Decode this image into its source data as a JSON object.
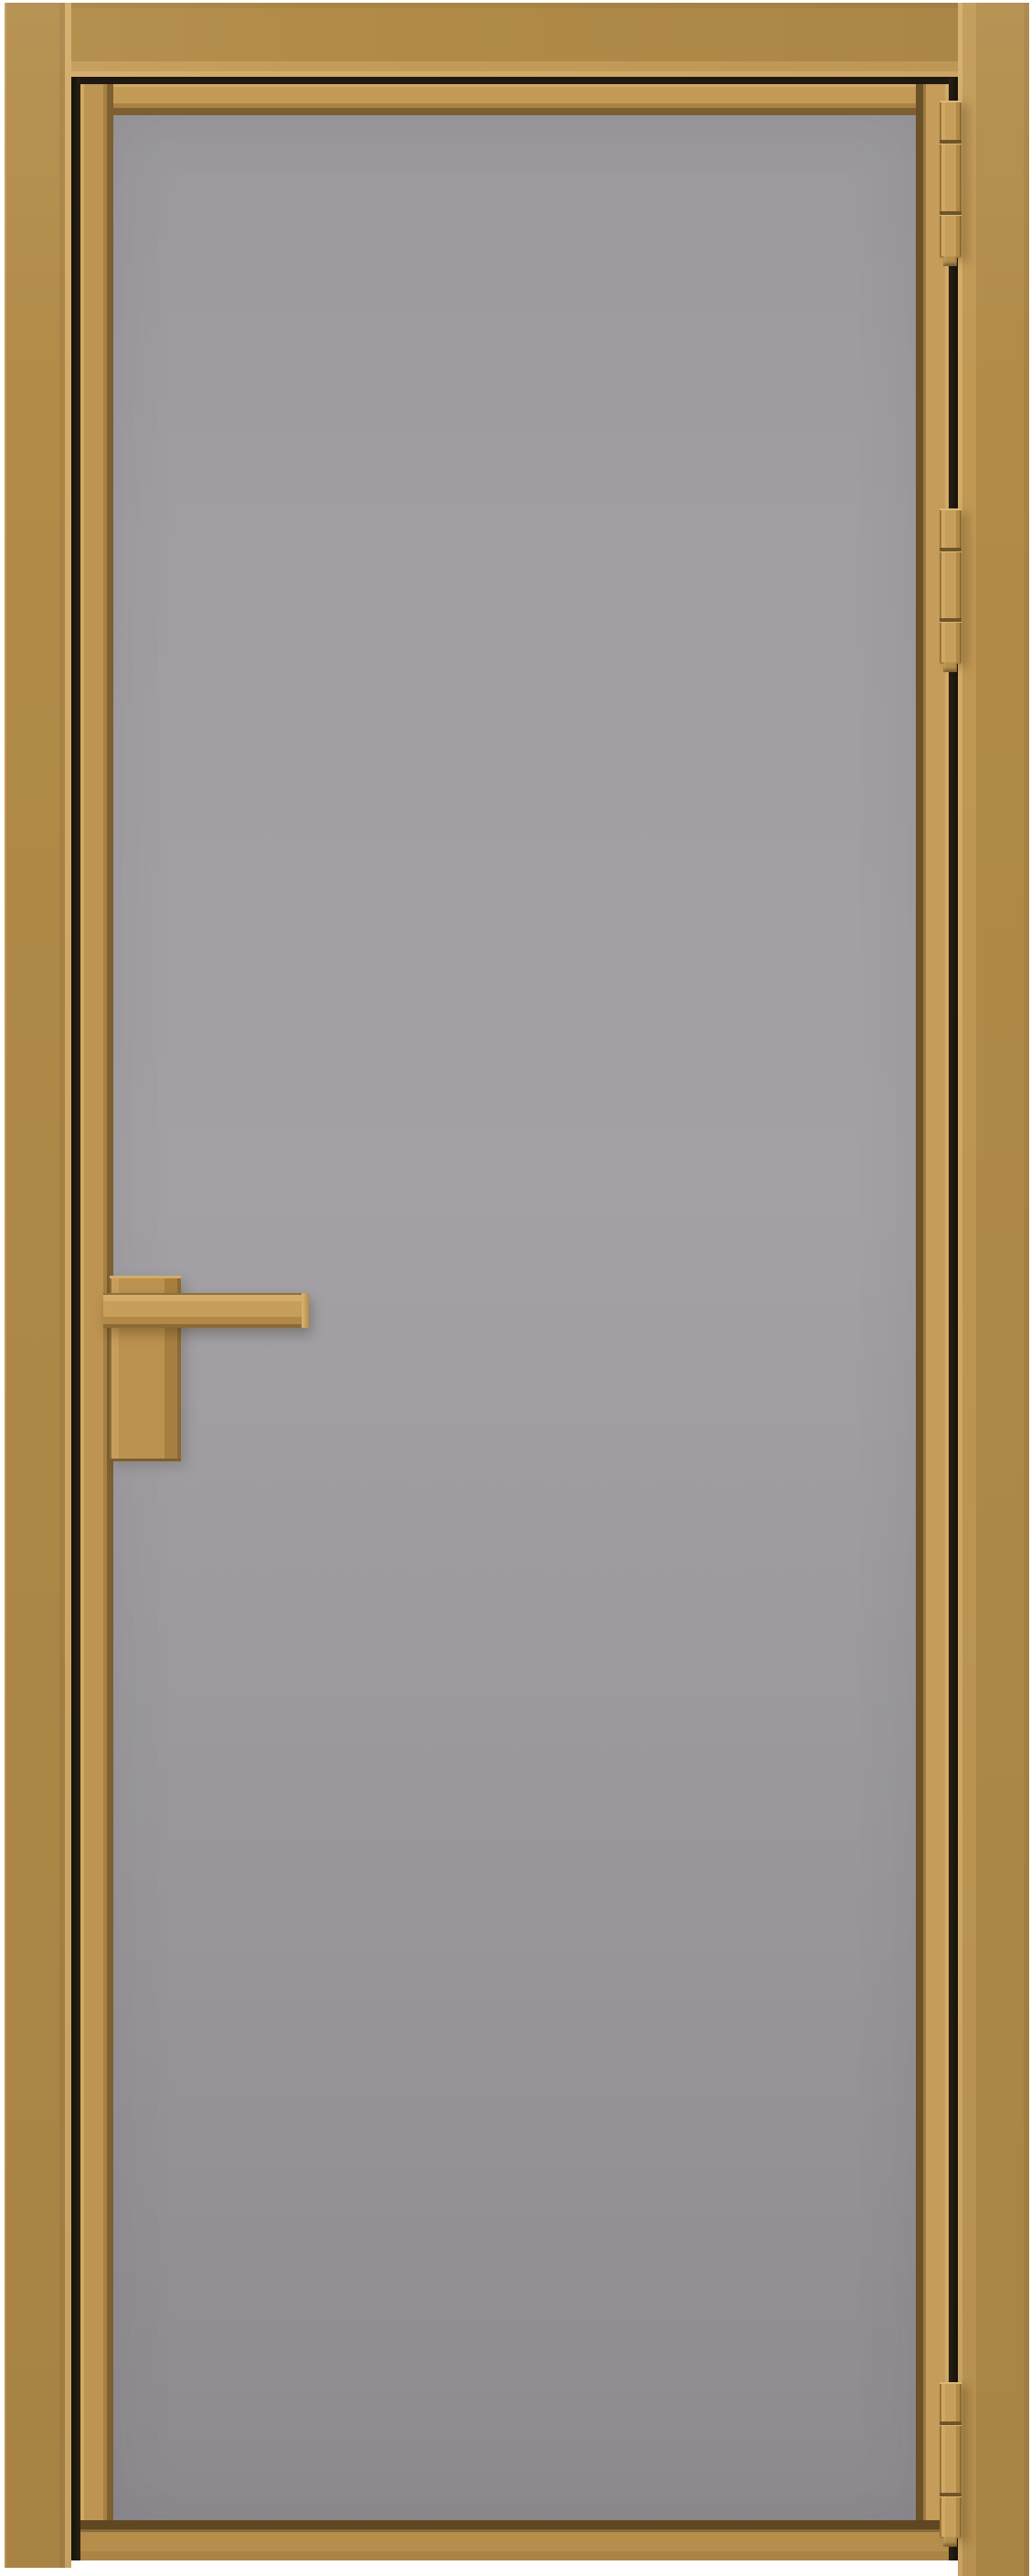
{
  "meta": {
    "type": "product-photo",
    "subject": "Interior single-leaf matte glass door in a gold aluminium frame",
    "view": "front",
    "text_content": "none"
  },
  "door": {
    "frame": {
      "material": "aluminium",
      "finish": "gold",
      "color": "#b28b48"
    },
    "leaf": {
      "frame_color": "#bd9451",
      "edge_highlight": "#d2ab68",
      "bevel_shadow": "#7d5f30"
    },
    "glass": {
      "finish": "matte",
      "color_top": "#9b999d",
      "color_mid": "#a3a1a5",
      "color_bottom": "#8d8b8f"
    },
    "gap_color": "#1f1810",
    "handle": {
      "type": "lever-on-backplate",
      "side": "left",
      "orientation": "horizontal",
      "color": "#c09751"
    },
    "hinges": {
      "count": 3,
      "side": "right",
      "color": "#c79f5d",
      "positions": [
        "top",
        "upper-middle",
        "bottom"
      ]
    }
  },
  "colors": {
    "background": "#ffffff",
    "gold_frame": "#b28b48",
    "gold_frame_deep": "#a98344",
    "gold_frame_light": "#c49c58",
    "gold_edge_highlight": "#d2ab68",
    "gold_leaf": "#bd9451",
    "gold_bevel": "#7d5f30",
    "gold_bevel_deep": "#5f4722",
    "gap_shadow": "#1f1810",
    "glass_top": "#9b999d",
    "glass_mid": "#a3a1a5",
    "glass_bottom": "#8d8b8f",
    "hinge_face": "#c79f5d",
    "hinge_seam": "#6f5429",
    "hinge_highlight": "#dcb876",
    "handle_face": "#c09751"
  }
}
